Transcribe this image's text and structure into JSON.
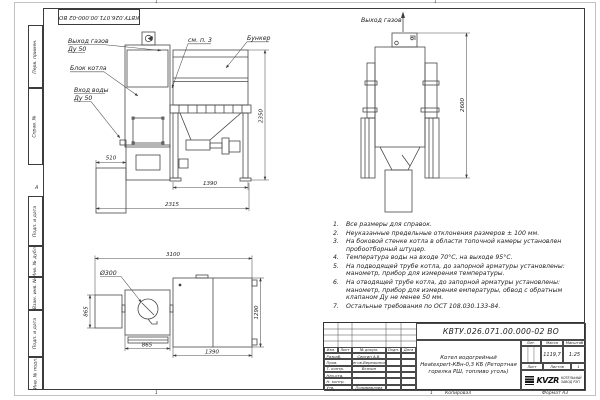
{
  "sheet": {
    "stamp_rotated": "КВТУ.026.071.00.000-02 ВО",
    "zone_top_left": "1",
    "zone_top_right": "1",
    "zone_bottom_left": "1",
    "zone_bottom_right": "1",
    "fold_mark": "А",
    "margin_labels": {
      "perv_primen": "Перв. примен.",
      "sprav_no": "Справ. №",
      "podp_data_1": "Подп. и дата",
      "inv_dubl": "Инв. № дубл.",
      "vzam_inv": "Взам. инв. №",
      "podp_data_2": "Подп. и дата",
      "inv_podl": "Инв. № подл."
    },
    "footer": {
      "kopiroval": "Копировал",
      "format": "Формат А3"
    }
  },
  "front_view": {
    "labels": {
      "gas_out": "Выход газов",
      "gas_out_dn": "Ду 50",
      "boiler_block": "Блок котла",
      "water_in": "Вход воды",
      "water_in_dn": "Ду 50",
      "see_note": "см. п. 3",
      "bunker": "Бункер"
    },
    "dims": {
      "d510": "510",
      "d1390": "1390",
      "d2315": "2315",
      "d2350": "2350"
    }
  },
  "side_view": {
    "labels": {
      "gas_out": "Выход газов"
    },
    "dims": {
      "d2600": "2600"
    }
  },
  "plan_view": {
    "labels": {
      "d300": "Ø300"
    },
    "dims": {
      "d3100": "3100",
      "d865v": "865",
      "d865h": "865",
      "d1390": "1390",
      "d1290": "1290"
    }
  },
  "notes": {
    "items": [
      {
        "num": "1.",
        "text": "Все размеры для справок."
      },
      {
        "num": "2.",
        "text": "Неуказанные предельные отклонения размеров ± 100 мм."
      },
      {
        "num": "3.",
        "text": "На боковой стенке котла в области топочной камеры установлен пробоотборный штуцер."
      },
      {
        "num": "4.",
        "text": "Температура воды на входе 70°С, на выходе 95°С."
      },
      {
        "num": "5.",
        "text": "На подводящей трубе котла, до запорной арматуры установлены: манометр, прибор для измерения температуры."
      },
      {
        "num": "6.",
        "text": "На отводящей трубе котла, до запорной арматуры установлены: манометр, прибор для измерения емпературы, обвод с обратным клапаном Ду не менее 50 мм."
      },
      {
        "num": "7.",
        "text": "Остальные требования по ОСТ 108.030.133-84."
      }
    ]
  },
  "title_block": {
    "doc_number": "КВТУ.026.071.00.000-02 ВО",
    "product_line1": "Котел водогрейный",
    "product_line2": "Heatexpert-КВн-0,3 КБ (Ретортная",
    "product_line3": "горелка РШ, топливо уголь)",
    "col_headers": {
      "izm": "Изм.",
      "list": "Лист",
      "dokum": "№ докум.",
      "podp": "Подп.",
      "data": "Дата"
    },
    "sig_rows": [
      {
        "role": "Разраб.",
        "name": "Сергин А.В."
      },
      {
        "role": "Пров.",
        "name": "Онегов-Вережинский"
      },
      {
        "role": "Т. контр.",
        "name": "Всячин"
      },
      {
        "role": "Нач.отд.",
        "name": ""
      },
      {
        "role": "Н. контр.",
        "name": ""
      },
      {
        "role": "Утв.",
        "name": "Полимарлова"
      }
    ],
    "lit_header": "Лит.",
    "massa_header": "Масса",
    "masshtab_header": "Масштаб",
    "massa_value": "1119,7",
    "masshtab_value": "1:25",
    "list_header": "Лист",
    "listov_header": "Листов",
    "listov_value": "1",
    "logo_text": "KVZR",
    "logo_caption1": "КОТЕЛЬНЫЙ",
    "logo_caption2": "ЗАВОД РЭП"
  }
}
